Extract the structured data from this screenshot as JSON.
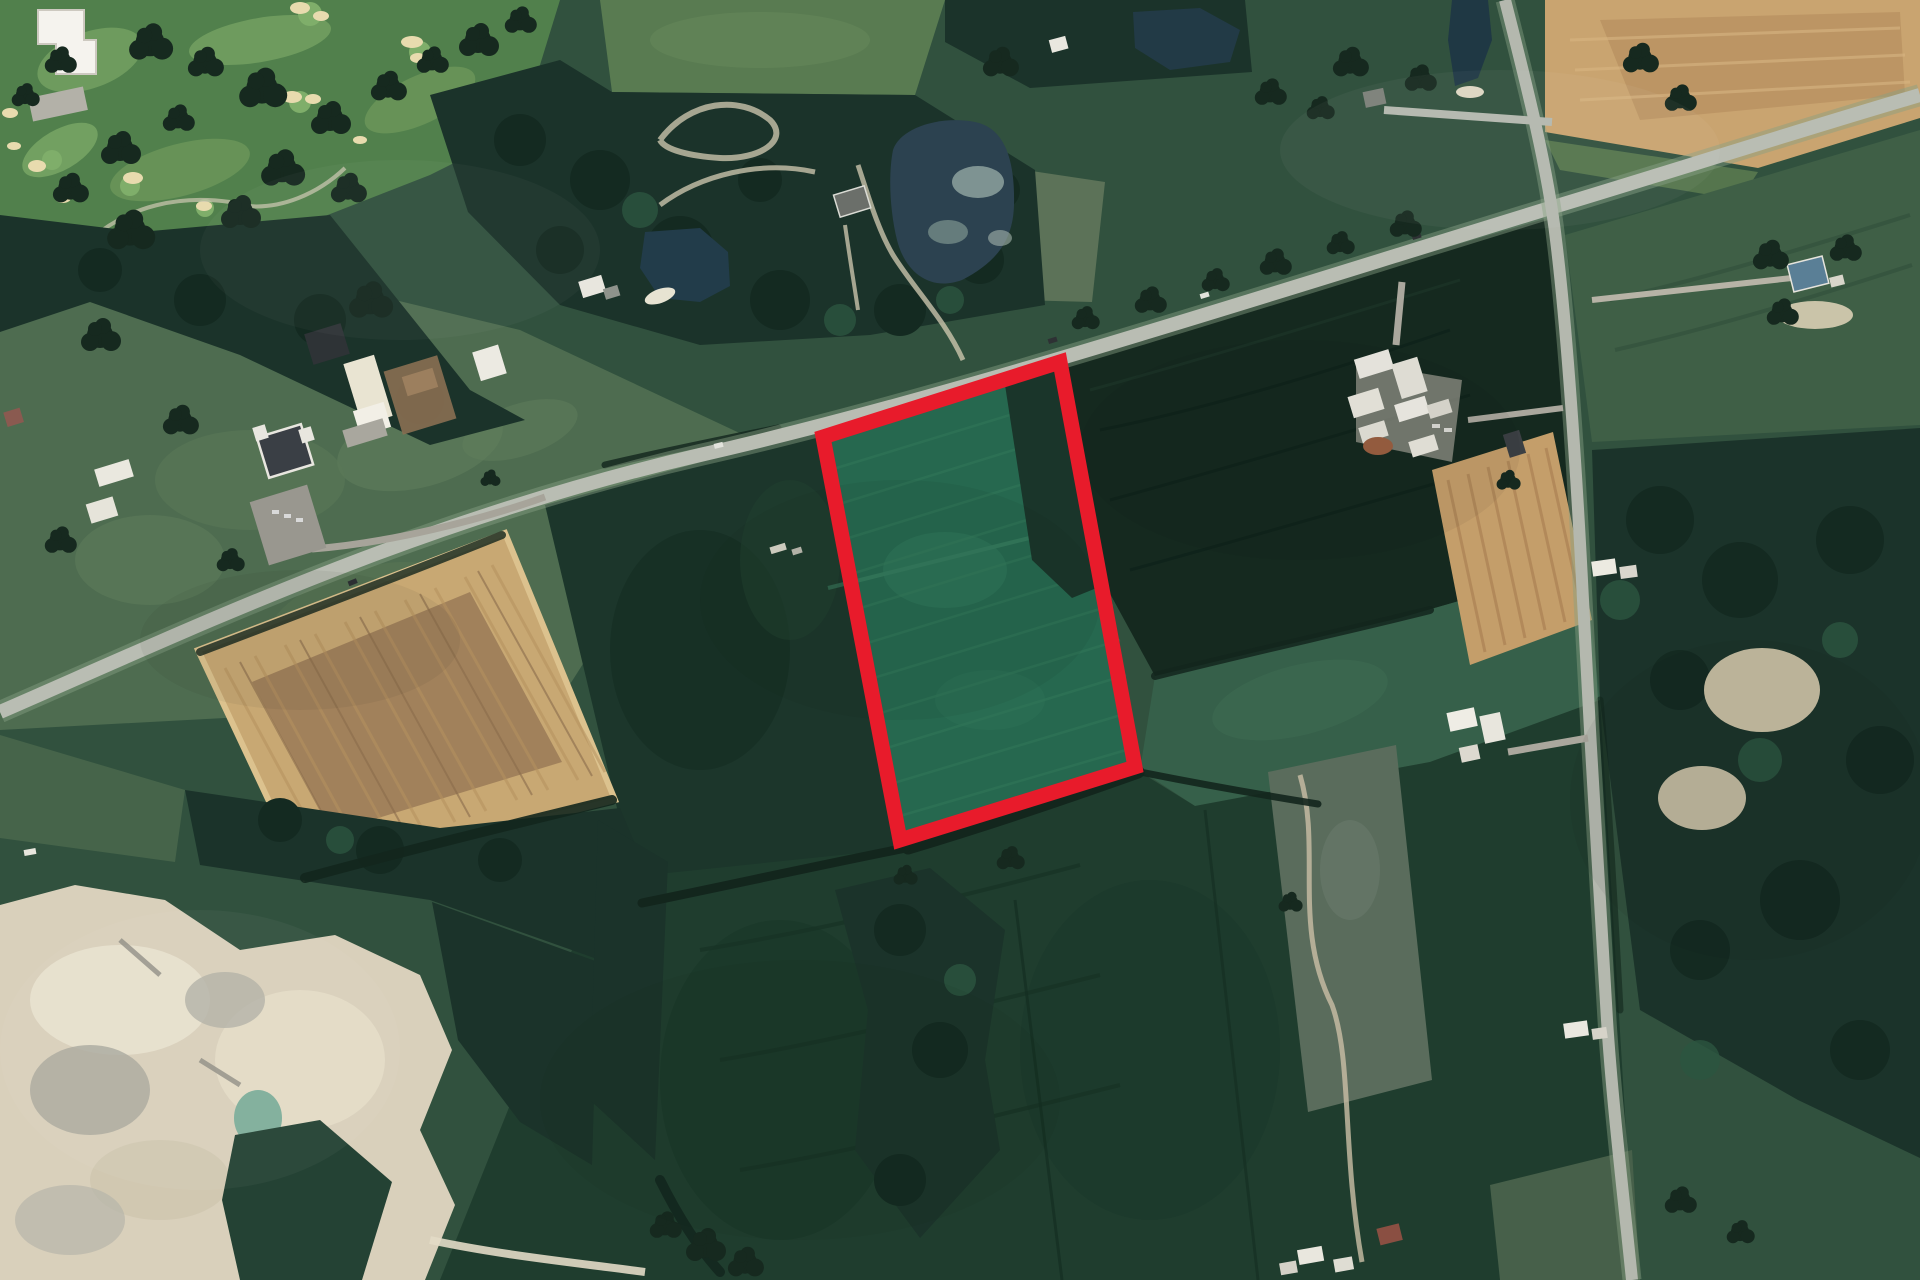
{
  "map": {
    "kind": "satellite aerial photograph of rural farmland with highlighted land parcel",
    "highlight": {
      "points": "823,437 1060,362 1135,767 900,840",
      "color": "#e81b2b",
      "stroke_width": "15"
    },
    "palette": {
      "forest": "#1b332a",
      "dark_crop_field": "#15291f",
      "parcel_field_green": "#26684f",
      "pasture_green": "#4e6c50",
      "golf_green": "#51804c",
      "tan_plowed_field": "#c8a873",
      "quarry_beige": "#d9d0bb",
      "road_gray": "#b9bdb3",
      "pond_blue": "#2c4250",
      "highlight_red": "#e81b2b"
    },
    "features": [
      "golf-course",
      "clubhouse",
      "woodlots",
      "ponds",
      "estate-house",
      "horse-farm",
      "pastures",
      "tan-plowed-field",
      "gravel-pit-quarry",
      "highlighted-parcel",
      "concession-road",
      "north-south-sideroad",
      "farm-complex",
      "crop-fields",
      "rural-houses",
      "quarry-pond",
      "scrub-land"
    ]
  }
}
